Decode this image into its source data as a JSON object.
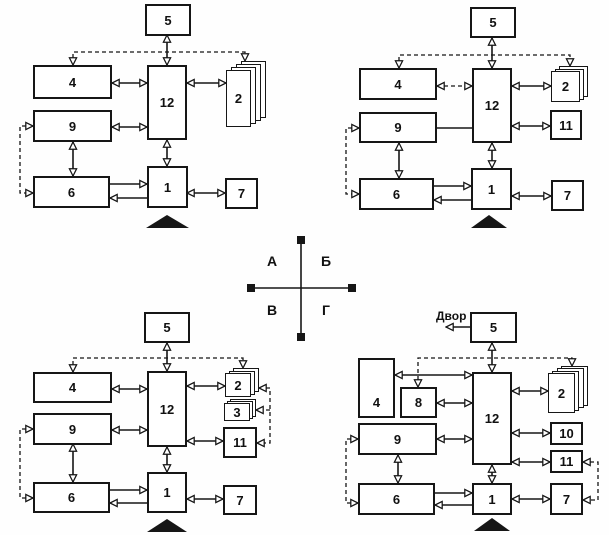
{
  "axis": {
    "a": "А",
    "b": "Б",
    "v": "В",
    "g": "Г"
  },
  "quadrants": {
    "a": {
      "boxes": {
        "b1": "1",
        "b2": "2",
        "b4": "4",
        "b5": "5",
        "b6": "6",
        "b7": "7",
        "b9": "9",
        "b12": "12"
      },
      "connections": [
        "5<->12",
        "4<->12",
        "12<->2",
        "9<->12",
        "9<->6",
        "12<->1",
        "6->1",
        "1->6",
        "1<->7",
        "dashed: top of 4 <-> top of 2",
        "dashed: left of 9 <-> left of 6"
      ]
    },
    "b": {
      "boxes": {
        "b1": "1",
        "b2": "2",
        "b4": "4",
        "b5": "5",
        "b6": "6",
        "b7": "7",
        "b9": "9",
        "b11": "11",
        "b12": "12"
      },
      "connections": [
        "5<->12",
        "4<->12 (dashed)",
        "12<->2",
        "12<->11",
        "9-12 (plain line)",
        "9<->6",
        "12<->1",
        "6->1",
        "1->6",
        "1<->7",
        "dashed: top of 4 <-> top of 2",
        "dashed: left of 9 <-> left of 6"
      ]
    },
    "v": {
      "boxes": {
        "b1": "1",
        "b2": "2",
        "b3": "3",
        "b4": "4",
        "b5": "5",
        "b6": "6",
        "b7": "7",
        "b9": "9",
        "b11": "11",
        "b12": "12"
      },
      "connections": [
        "5<->12",
        "4<->12",
        "12<->2",
        "9<->12",
        "12<->11",
        "9<->6",
        "12<->1",
        "6->1",
        "1->6",
        "1<->7",
        "dashed: top of 4 <-> top of 2",
        "dashed: left of 9 <-> left of 6",
        "dashed: right of 2 <-> right of 3 <-> right of 11"
      ]
    },
    "g": {
      "yard_label": "Двор",
      "boxes": {
        "b1": "1",
        "b2": "2",
        "b4": "4",
        "b5": "5",
        "b6": "6",
        "b7": "7",
        "b8": "8",
        "b9": "9",
        "b10": "10",
        "b11": "11",
        "b12": "12"
      },
      "connections": [
        "5->Двор",
        "5<->12",
        "4<->12",
        "8<->12",
        "9<->12",
        "12<->2",
        "12<->10",
        "12<->11",
        "9<->6",
        "12<->1",
        "6->1",
        "1->6",
        "1<->7",
        "dashed: top of 8 <-> top of 2",
        "dashed: left of 9 <-> left of 6",
        "dashed: right of 11 <-> right of 7"
      ]
    }
  },
  "colors": {
    "line": "#161616",
    "box_border": "#161616",
    "background": "#fefefe"
  }
}
